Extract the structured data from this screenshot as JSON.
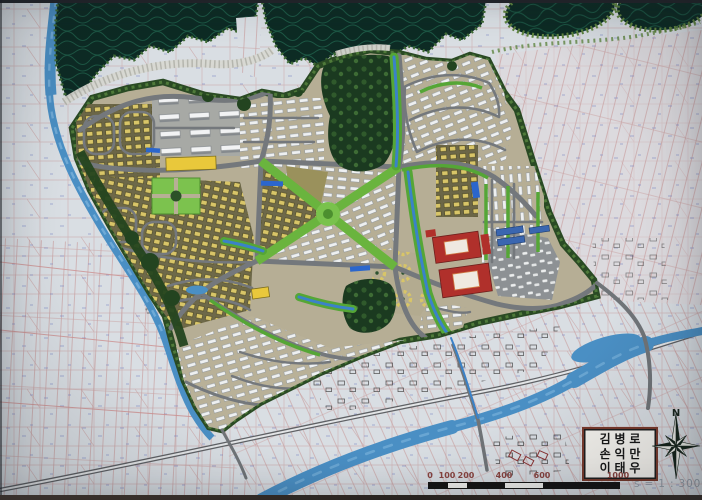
{
  "plate": {
    "names": [
      "김병로",
      "손익만",
      "이태우"
    ]
  },
  "compass": {
    "north_label": "N"
  },
  "scalebar": {
    "ticks": [
      "0",
      "100",
      "200",
      "400",
      "600",
      "1000"
    ],
    "ratio": "s = 1 : 3000"
  },
  "palette": {
    "paper": "#d9dee3",
    "cadastral_line": "#c89c9c",
    "cadastral_mark_blue": "#6b79c0",
    "forest_dark": "#0d2b24",
    "forest_contour": "#1f5f4a",
    "moss_green": "#5f8440",
    "site_ground": "#b6ae95",
    "road_gray": "#74787c",
    "park_green": "#6ab43e",
    "street_green": "#55a636",
    "house_yellow": "#d8c568",
    "rowhouse_white": "#eef0f1",
    "commercial_red": "#b0302b",
    "school_yellow": "#e9c83b",
    "river_blue": "#4a8fc4",
    "channel_blue": "#3b82c8",
    "bridge_blue": "#2b66cc",
    "village_ink": "#474747",
    "tick_red": "#8b4540",
    "plate_border": "#7a3a2c"
  }
}
